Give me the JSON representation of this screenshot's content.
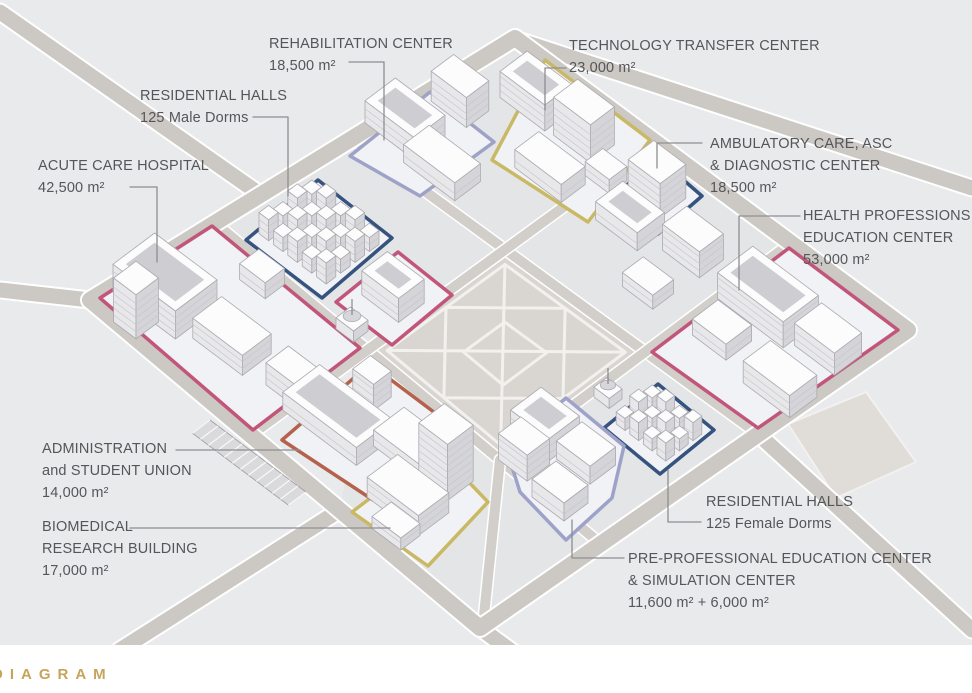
{
  "canvas": {
    "width": 972,
    "height": 693,
    "background": "#e9eaec",
    "paper_strip": "#ffffff"
  },
  "footer": {
    "brand_text": "DIAGRAM",
    "brand_color": "#c6a45a"
  },
  "palette": {
    "residential_outline": "#35537e",
    "academic_outline": "#9fa2c8",
    "research_outline": "#c9b964",
    "medical_outline": "#c2557a",
    "admin_outline": "#b5624d",
    "road": "#ccc8c3",
    "road_inner": "#d2cec9",
    "block_pad": "#e4e5e7",
    "plaza": "#d9d6d1",
    "leader": "#8e8e92",
    "label_text": "#55565a"
  },
  "labels": [
    {
      "id": "rehabilitation-center",
      "lines": [
        "REHABILITATION CENTER",
        "18,500 m²"
      ]
    },
    {
      "id": "technology-transfer-center",
      "lines": [
        "TECHNOLOGY TRANSFER CENTER",
        "23,000 m²"
      ]
    },
    {
      "id": "residential-halls-male",
      "lines": [
        "RESIDENTIAL HALLS",
        "125 Male Dorms"
      ]
    },
    {
      "id": "acute-care-hospital",
      "lines": [
        "ACUTE CARE HOSPITAL",
        "42,500 m²"
      ]
    },
    {
      "id": "ambulatory-care-asc-diagnostic-center",
      "lines": [
        "AMBULATORY CARE, ASC",
        "& DIAGNOSTIC CENTER",
        "18,500 m²"
      ]
    },
    {
      "id": "health-professions-education-center",
      "lines": [
        "HEALTH PROFESSIONS",
        "EDUCATION CENTER",
        "53,000 m²"
      ]
    },
    {
      "id": "administration-student-union",
      "lines": [
        "ADMIN­ISTRATION",
        "and STUDENT UNION",
        "14,000 m²"
      ]
    },
    {
      "id": "biomedical-research-building",
      "lines": [
        "BIOMEDICAL",
        "RESEARCH BUILDING",
        "17,000 m²"
      ]
    },
    {
      "id": "residential-halls-female",
      "lines": [
        "RESIDENTIAL HALLS",
        "125 Female Dorms"
      ]
    },
    {
      "id": "pre-professional-education-simulation",
      "lines": [
        "PRE-PROFESSIONAL EDUCATION CENTER",
        "& SIMULATION CENTER",
        "11,600 m² + 6,000 m²"
      ]
    }
  ]
}
